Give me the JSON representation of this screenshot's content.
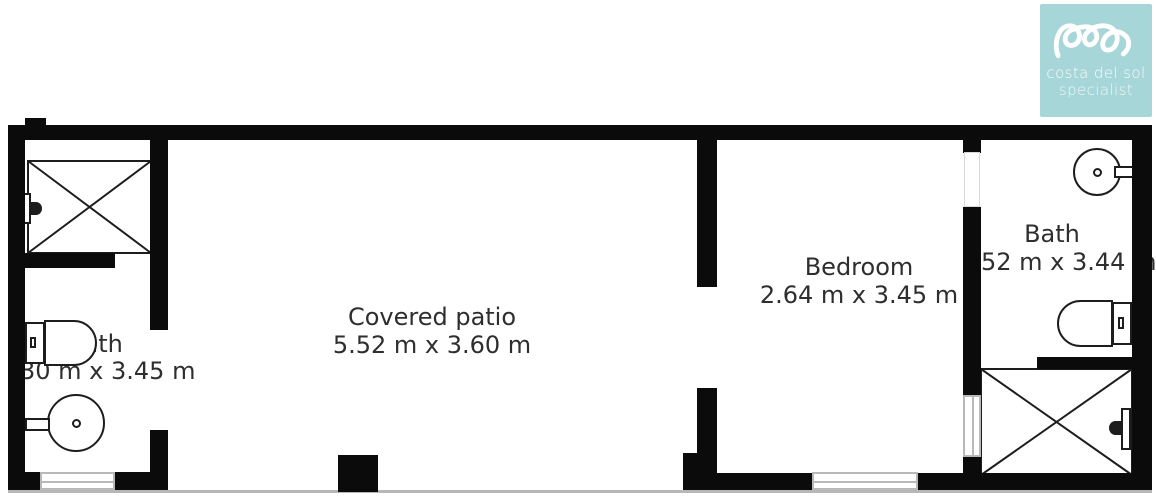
{
  "logo": {
    "line1": "costa del sol",
    "line2": "specialist",
    "bg_color": "#a7d6d9",
    "mark": "squiggle-loops-icon"
  },
  "rooms": {
    "bath_left": {
      "label": "Bath",
      "dims": "30 m x 3.45 m"
    },
    "patio": {
      "label": "Covered patio",
      "dims": "5.52 m x 3.60 m"
    },
    "bedroom": {
      "label": "Bedroom",
      "dims": "2.64 m x 3.45 m"
    },
    "bath_right": {
      "label": "Bath",
      "dims": "52 m x 3.44 m"
    }
  },
  "fixtures": {
    "bath_left": [
      "shower",
      "shower-head",
      "toilet",
      "sink",
      "window"
    ],
    "bath_right": [
      "sink",
      "toilet",
      "shower",
      "shower-head",
      "window",
      "window-upper"
    ],
    "bedroom": [
      "window"
    ],
    "patio": [
      "pillar"
    ]
  },
  "colors": {
    "wall": "#0b0b0b",
    "text": "#2e2e2e",
    "window_frame": "#b9b9b9",
    "accent_teal": "#a7d6d9"
  }
}
